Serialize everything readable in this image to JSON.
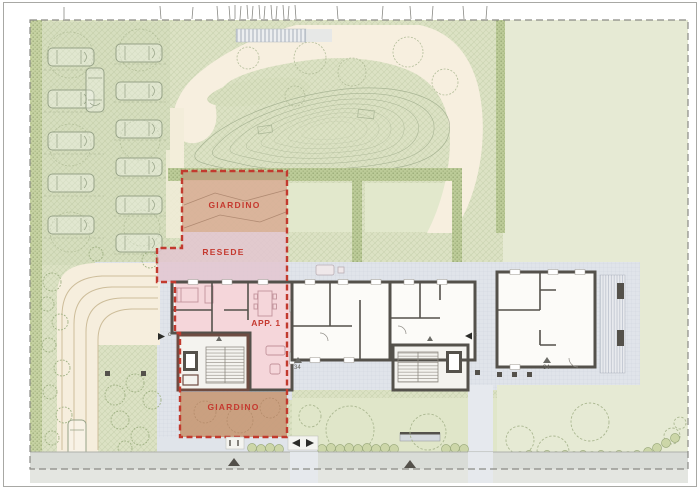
{
  "plan": {
    "labels": {
      "garden_top": "GIARDINO",
      "resede": "RESEDE",
      "apartment": "APP. 1",
      "garden_bottom": "GIARDINO"
    },
    "markers": {
      "entry_left": "c",
      "entry_right": "c",
      "level_mid": "34",
      "level_right": "34"
    },
    "colors": {
      "site_green": "#dce2c4",
      "light_green": "#e6ead4",
      "garden_strip_green": "#e2e8cc",
      "hedge_green": "#bccb98",
      "path_beige": "#f7efdf",
      "paving_gray": "#e0e4ea",
      "road_gray": "#d9dcd7",
      "wall_dark": "#54514b",
      "parcel_red": "#c23a2e",
      "garden_top_fill": "#d9b097",
      "resede_fill": "#e3c6d0",
      "apartment_fill": "#f2cdd2",
      "garden_bottom_fill": "#c89c7c"
    }
  }
}
